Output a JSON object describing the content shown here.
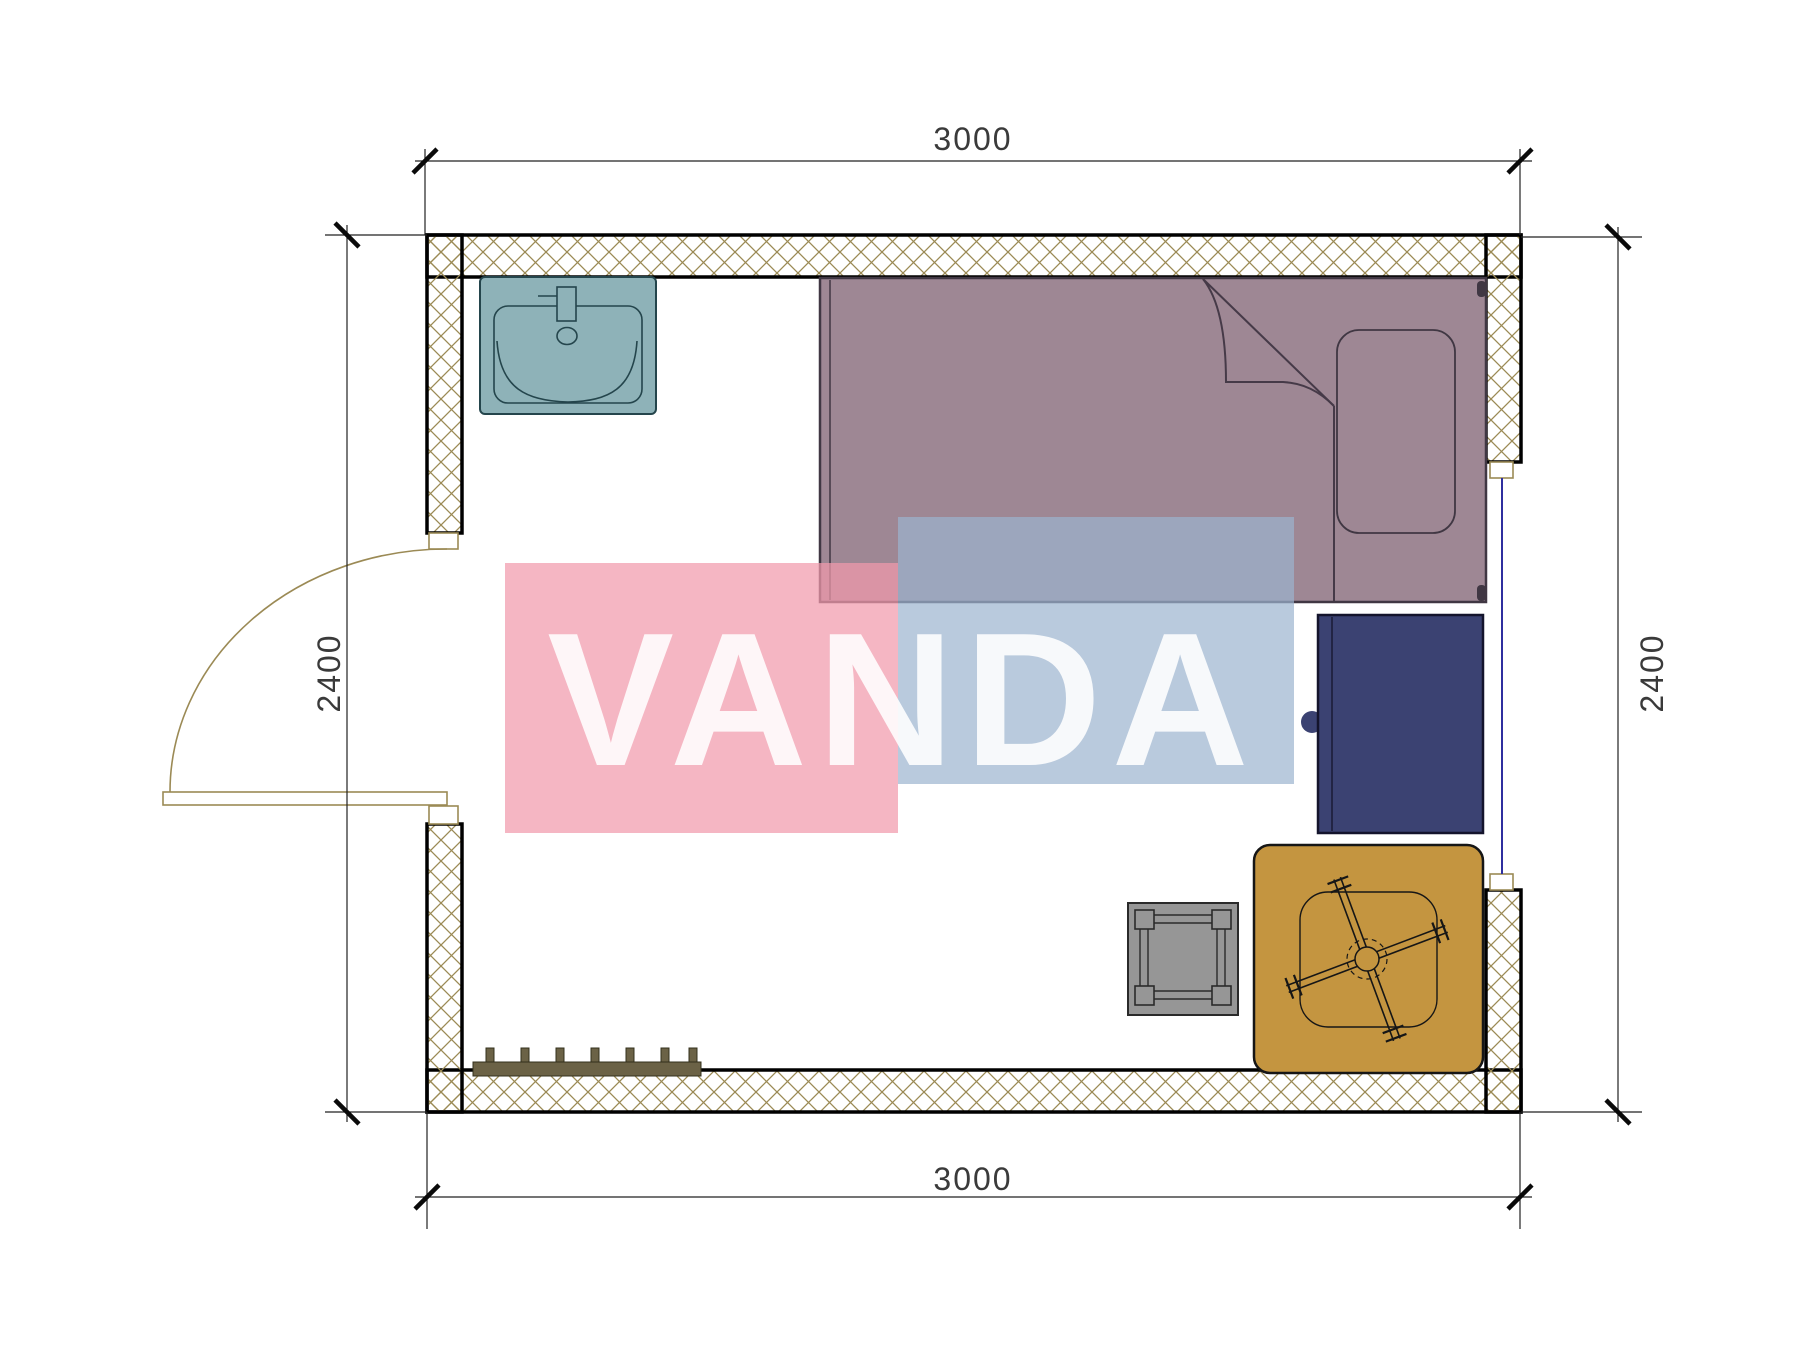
{
  "dimensions": {
    "top": "3000",
    "bottom": "3000",
    "left": "2400",
    "right": "2400"
  },
  "watermark": {
    "text": "VANDA",
    "pink_color": "#f19aac",
    "blue_color": "#9bb4cf",
    "text_color": "#ffffff"
  },
  "plan": {
    "wall_hatch_color": "#9b8a55",
    "wall_outline_color": "#000000",
    "dimension_line_color": "#222222",
    "symbols": [
      {
        "name": "sink-symbol",
        "color": "#8eb2b8"
      },
      {
        "name": "bed-symbol",
        "color": "#9e8794"
      },
      {
        "name": "wardrobe-symbol",
        "color": "#3b4272"
      },
      {
        "name": "table-symbol",
        "color": "#c49540"
      },
      {
        "name": "stool-symbol",
        "color": "#969696"
      },
      {
        "name": "radiator-symbol",
        "color": "#6b6246"
      },
      {
        "name": "door-swing-symbol",
        "color": "#9b8a55"
      },
      {
        "name": "window-symbol",
        "color": "#2f2f9f"
      }
    ]
  }
}
